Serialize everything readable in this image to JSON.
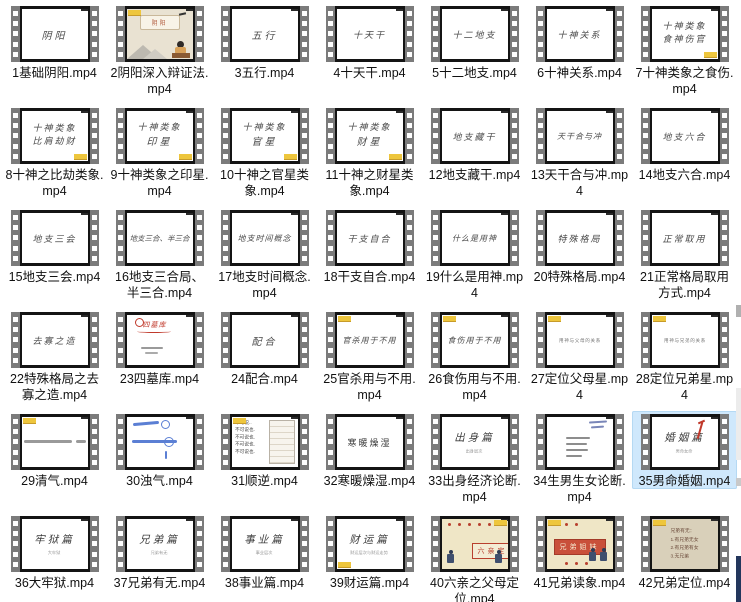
{
  "theme": {
    "background": "#ffffff",
    "selection_highlight": "#cfe8fc",
    "film_strip_gray": "#7b7b7b",
    "film_frame_border": "#141414",
    "badge_yellow": "#eec63d",
    "filename_text": "#111111",
    "calligraphy_ink": "#4a4a4a",
    "accent_red": "#b8402e",
    "handwriting_blue": "#5b7fd4",
    "thumb_cream": "#efe6c6",
    "thumb_tan": "#d9d0ba"
  },
  "items": [
    {
      "id": 1,
      "name": "1基础阴阳.mp4",
      "thumb": {
        "style": "cal",
        "lines": [
          "阴阳"
        ]
      }
    },
    {
      "id": 2,
      "name": "2阴阳深入辩证法.mp4",
      "thumb": {
        "style": "scene",
        "lines": [
          "阴阳"
        ],
        "badge": "tl"
      }
    },
    {
      "id": 3,
      "name": "3五行.mp4",
      "thumb": {
        "style": "cal",
        "lines": [
          "五行"
        ]
      }
    },
    {
      "id": 4,
      "name": "4十天干.mp4",
      "thumb": {
        "style": "cal",
        "lines": [
          "十天干"
        ]
      }
    },
    {
      "id": 5,
      "name": "5十二地支.mp4",
      "thumb": {
        "style": "cal",
        "lines": [
          "十二地支"
        ]
      }
    },
    {
      "id": 6,
      "name": "6十神关系.mp4",
      "thumb": {
        "style": "cal",
        "lines": [
          "十神关系"
        ]
      }
    },
    {
      "id": 7,
      "name": "7十神类象之食伤.mp4",
      "thumb": {
        "style": "cal",
        "lines": [
          "十神类象",
          "食神伤官"
        ],
        "badge": "br"
      }
    },
    {
      "id": 8,
      "name": "8十神之比劫类象.mp4",
      "thumb": {
        "style": "cal",
        "lines": [
          "十神类象",
          "比肩劫财"
        ],
        "badge": "br"
      }
    },
    {
      "id": 9,
      "name": "9十神类象之印星.mp4",
      "thumb": {
        "style": "cal",
        "lines": [
          "十神类象",
          "印星"
        ],
        "badge": "br"
      }
    },
    {
      "id": 10,
      "name": "10十神之官星类象.mp4",
      "thumb": {
        "style": "cal",
        "lines": [
          "十神类象",
          "官星"
        ],
        "badge": "br"
      }
    },
    {
      "id": 11,
      "name": "11十神之财星类象.mp4",
      "thumb": {
        "style": "cal",
        "lines": [
          "十神类象",
          "财星"
        ],
        "badge": "br"
      }
    },
    {
      "id": 12,
      "name": "12地支藏干.mp4",
      "thumb": {
        "style": "cal",
        "lines": [
          "地支藏干"
        ]
      }
    },
    {
      "id": 13,
      "name": "13天干合与冲.mp4",
      "thumb": {
        "style": "cal",
        "lines": [
          "天干合与冲"
        ]
      }
    },
    {
      "id": 14,
      "name": "14地支六合.mp4",
      "thumb": {
        "style": "cal",
        "lines": [
          "地支六合"
        ]
      }
    },
    {
      "id": 15,
      "name": "15地支三会.mp4",
      "thumb": {
        "style": "cal",
        "lines": [
          "地支三会"
        ]
      }
    },
    {
      "id": 16,
      "name": "16地支三合局、半三合.mp4",
      "thumb": {
        "style": "cal",
        "lines": [
          "地支三合、半三合"
        ]
      }
    },
    {
      "id": 17,
      "name": "17地支时间概念.mp4",
      "thumb": {
        "style": "cal",
        "lines": [
          "地支时间概念"
        ]
      }
    },
    {
      "id": 18,
      "name": "18干支自合.mp4",
      "thumb": {
        "style": "cal",
        "lines": [
          "干支自合"
        ]
      }
    },
    {
      "id": 19,
      "name": "19什么是用神.mp4",
      "thumb": {
        "style": "cal",
        "lines": [
          "什么是用神"
        ]
      }
    },
    {
      "id": 20,
      "name": "20特殊格局.mp4",
      "thumb": {
        "style": "cal",
        "lines": [
          "特殊格局"
        ]
      }
    },
    {
      "id": 21,
      "name": "21正常格局取用方式.mp4",
      "thumb": {
        "style": "cal",
        "lines": [
          "正常取用"
        ]
      }
    },
    {
      "id": 22,
      "name": "22特殊格局之去寡之造.mp4",
      "thumb": {
        "style": "cal",
        "lines": [
          "去寡之造"
        ]
      }
    },
    {
      "id": 23,
      "name": "23四墓库.mp4",
      "thumb": {
        "style": "rednotes",
        "lines": [
          "四墓库"
        ]
      }
    },
    {
      "id": 24,
      "name": "24配合.mp4",
      "thumb": {
        "style": "cal",
        "lines": [
          "配合"
        ]
      }
    },
    {
      "id": 25,
      "name": "25官杀用与不用.mp4",
      "thumb": {
        "style": "cal",
        "lines": [
          "官杀用于不用"
        ],
        "badge": "tl"
      }
    },
    {
      "id": 26,
      "name": "26食伤用与不用.mp4",
      "thumb": {
        "style": "cal",
        "lines": [
          "食伤用于不用"
        ],
        "badge": "tl"
      }
    },
    {
      "id": 27,
      "name": "27定位父母星.mp4",
      "thumb": {
        "style": "smalltext",
        "lines": [
          "用神与父母的关系"
        ],
        "badge": "tl"
      }
    },
    {
      "id": 28,
      "name": "28定位兄弟星.mp4",
      "thumb": {
        "style": "smalltext",
        "lines": [
          "用神与兄弟的关系"
        ],
        "badge": "tl"
      }
    },
    {
      "id": 29,
      "name": "29清气.mp4",
      "thumb": {
        "style": "scribline",
        "badge": "tl"
      }
    },
    {
      "id": 30,
      "name": "30浊气.mp4",
      "thumb": {
        "style": "bluenotes"
      }
    },
    {
      "id": 31,
      "name": "31顺逆.mp4",
      "thumb": {
        "style": "listtable",
        "lines": [
          "不可说..",
          "不可说也.",
          "不可说也.",
          "不可说也.",
          "不可说也."
        ],
        "badge": "tl"
      }
    },
    {
      "id": 32,
      "name": "32寒暖燥湿.mp4",
      "thumb": {
        "style": "serif",
        "lines": [
          "寒暖燥湿"
        ]
      }
    },
    {
      "id": 33,
      "name": "33出身经济论断.mp4",
      "thumb": {
        "style": "titlesub",
        "lines": [
          "出身篇"
        ],
        "sub": "出身层次"
      }
    },
    {
      "id": 34,
      "name": "34生男生女论断.mp4",
      "thumb": {
        "style": "numbered"
      }
    },
    {
      "id": 35,
      "name": "35男命婚姻.mp4",
      "selected": true,
      "thumb": {
        "style": "titlesubred",
        "lines": [
          "婚姻篇"
        ],
        "sub": "男命女命"
      }
    },
    {
      "id": 36,
      "name": "36大牢狱.mp4",
      "thumb": {
        "style": "titlesub",
        "lines": [
          "牢狱篇"
        ],
        "sub": "大牢狱"
      }
    },
    {
      "id": 37,
      "name": "37兄弟有无.mp4",
      "thumb": {
        "style": "titlesub",
        "lines": [
          "兄弟篇"
        ],
        "sub": "兄弟有无"
      }
    },
    {
      "id": 38,
      "name": "38事业篇.mp4",
      "thumb": {
        "style": "titlesub",
        "lines": [
          "事业篇"
        ],
        "sub": "事业层次"
      }
    },
    {
      "id": 39,
      "name": "39财运篇.mp4",
      "thumb": {
        "style": "titlesub",
        "lines": [
          "财运篇"
        ],
        "sub": "财运层次与财运走势",
        "badge": "bl"
      }
    },
    {
      "id": 40,
      "name": "40六亲之父母定位.mp4",
      "thumb": {
        "style": "creambox",
        "box": "六亲定位",
        "badge": "tr"
      }
    },
    {
      "id": 41,
      "name": "41兄弟读象.mp4",
      "thumb": {
        "style": "creambox2",
        "box": "兄弟姐妹",
        "badge": "tl"
      }
    },
    {
      "id": 42,
      "name": "42兄弟定位.mp4",
      "thumb": {
        "style": "creamlist",
        "lines": [
          "兄弟有无：",
          "1.有兄弟无女",
          "2.有兄弟有女",
          "3.无兄弟"
        ],
        "badge": "tl"
      }
    }
  ],
  "right_edge_fragments": [
    {
      "y": 305,
      "h": 12,
      "color": "#b0b0b0"
    },
    {
      "y": 388,
      "h": 72,
      "color": "#ececec"
    },
    {
      "y": 478,
      "h": 8,
      "color": "#c9c9c9"
    },
    {
      "y": 556,
      "h": 46,
      "color": "#23365c"
    }
  ]
}
